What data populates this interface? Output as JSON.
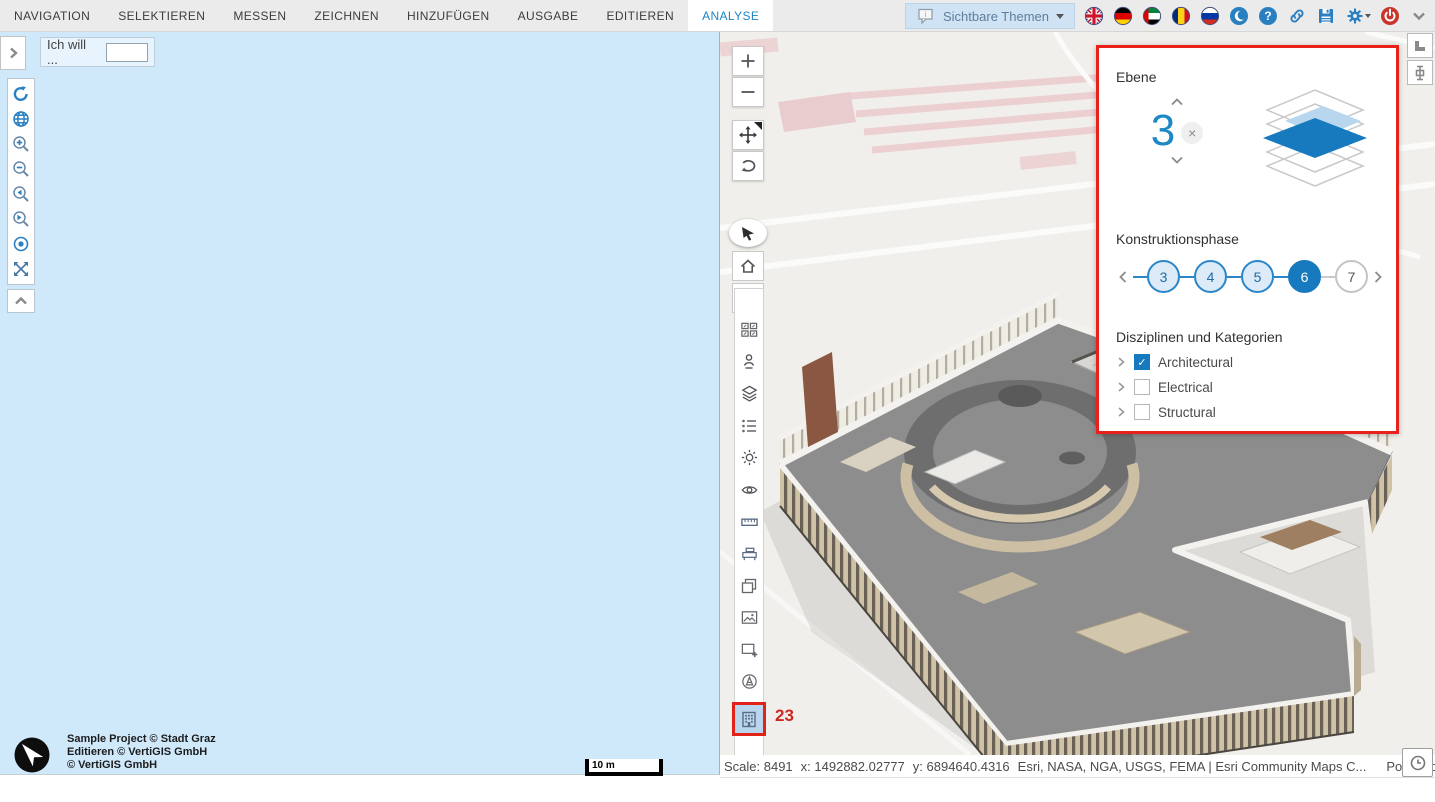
{
  "topbar": {
    "tabs": [
      {
        "label": "NAVIGATION"
      },
      {
        "label": "SELEKTIEREN"
      },
      {
        "label": "MESSEN"
      },
      {
        "label": "ZEICHNEN"
      },
      {
        "label": "HINZUFÜGEN"
      },
      {
        "label": "AUSGABE"
      },
      {
        "label": "EDITIEREN"
      },
      {
        "label": "ANALYSE"
      }
    ],
    "active_tab": "ANALYSE",
    "themes_button": {
      "label": "Sichtbare Themen"
    }
  },
  "left_panel": {
    "iwtt_label": "Ich will ...",
    "input_value": ""
  },
  "copyright": {
    "lines": [
      "Sample Project © Stadt Graz",
      "Editieren © VertiGIS GmbH",
      "© VertiGIS GmbH"
    ]
  },
  "scalebar": {
    "label": "10 m"
  },
  "layer_panel": {
    "level_section_title": "Ebene",
    "level_value": "3",
    "clear_label": "×",
    "phase_section_title": "Konstruktionsphase",
    "phases": [
      {
        "value": "3",
        "state": "done"
      },
      {
        "value": "4",
        "state": "done"
      },
      {
        "value": "5",
        "state": "done"
      },
      {
        "value": "6",
        "state": "selected"
      },
      {
        "value": "7",
        "state": "future"
      }
    ],
    "disciplines_section_title": "Disziplinen und Kategorien",
    "disciplines": [
      {
        "label": "Architectural",
        "checked": true
      },
      {
        "label": "Electrical",
        "checked": false
      },
      {
        "label": "Structural",
        "checked": false
      }
    ],
    "check_glyph": "✓"
  },
  "map": {
    "annotation_badge": "23"
  },
  "statusbar": {
    "scale": "Scale: 8491",
    "x": "x: 1492882.02777",
    "y": "y: 6894640.4316",
    "attribution": "Esri, NASA, NGA, USGS, FEMA | Esri Community Maps C...",
    "powered_by": "Powered by Es"
  },
  "colors": {
    "accent_blue": "#1779be",
    "highlight_red": "#e8221b",
    "panel_blue": "#cfe9fb",
    "active_tab_text": "#1a86c8"
  }
}
